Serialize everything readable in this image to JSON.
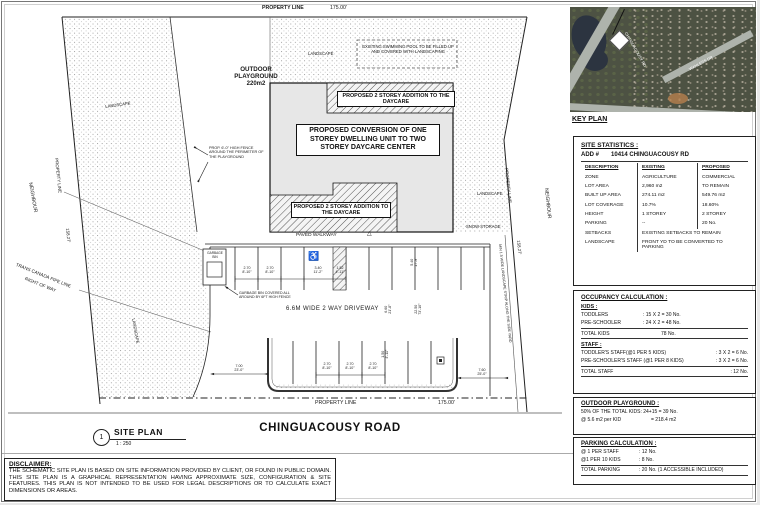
{
  "keyplan": {
    "label": "KEY PLAN",
    "road1": "CHINGUACOUSY RD",
    "road2": "WANLESS DR"
  },
  "stats": {
    "title": "SITE STATISTICS :",
    "addr_label": "ADD #",
    "addr": "10414 CHINGUACOUSY RD",
    "h_desc": "DESCRIPTION",
    "h_exist": "EXISTING",
    "h_prop": "PROPOSED",
    "rows": [
      {
        "d": "ZONE",
        "e": "AGRICULTURE",
        "p": "COMMERCIAL"
      },
      {
        "d": "LOT AREA",
        "e": "2,960 m2",
        "p": "TO REMAIN"
      },
      {
        "d": "BUILT UP AREA",
        "e": "274.11 m2",
        "p": "549.76 m2"
      },
      {
        "d": "LOT COVERAGE",
        "e": "10.7%",
        "p": "18.60%"
      },
      {
        "d": "HEIGHT",
        "e": "1 STOREY",
        "p": "2 STOREY"
      },
      {
        "d": "PARKING",
        "e": "--",
        "p": "20 No."
      }
    ],
    "span_rows": [
      {
        "d": "SETBACKS",
        "v": "EXISTING SETBACKS TO REMAIN"
      },
      {
        "d": "LANDSCAPE",
        "v": "FRONT YD TO BE CONVERTED TO PARKING"
      }
    ]
  },
  "occupancy": {
    "title": "OCCUPANCY CALCULATION :",
    "kids_title": "KIDS :",
    "kids": [
      {
        "l": "TODDLERS",
        "v": ": 15 X 2 = 30 No."
      },
      {
        "l": "PRE-SCHOOLER",
        "v": ": 24 X 2 = 48 No."
      }
    ],
    "kids_total_l": "TOTAL KIDS",
    "kids_total_v": "78 No.",
    "staff_title": "STAFF :",
    "staff": [
      {
        "l": "TODDLER'S STAFF(@1 PER 5 KIDS)",
        "v": ": 3 X 2 = 6 No."
      },
      {
        "l": "PRE-SCHOOLER'S STAFF (@1 PER 8 KIDS)",
        "v": ": 3 X 2 = 6 No."
      }
    ],
    "staff_total_l": "TOTAL STAFF",
    "staff_total_v": ": 12 No."
  },
  "playground_calc": {
    "title": "OUTDOOR PLAYGROUND :",
    "line1": "50% OF THE TOTAL KIDS: 24+15 = 39 No.",
    "line2l": "@ 5.6 m2 per KID",
    "line2v": "= 218.4 m2"
  },
  "parking_calc": {
    "title": "PARKING CALCULATION :",
    "rows": [
      {
        "l": "@ 1 PER STAFF",
        "v": ": 12 No."
      },
      {
        "l": "@1 PER 10 KIDS",
        "v": ": 8 No."
      }
    ],
    "total_l": "TOTAL PARKING",
    "total_v": ": 20 No. (1 ACCESSIBLE INCLUDED)"
  },
  "disclaimer": {
    "title": "DISCLAIMER:",
    "body": "THE SCHEMATIC SITE PLAN IS BASED ON SITE INFORMATION PROVIDED BY CLIENT, OR FOUND IN PUBLIC DOMAIN. THIS SITE PLAN IS A GRAPHICAL REPRESENTATION HAVING APPROXIMATE SIZE, CONFIGURATION & SITE FEATURES. THIS PLAN IS NOT INTENDED TO BE USED FOR LEGAL DESCRIPTIONS OR TO CALCULATE EXACT DIMENSIONS OR AREAS."
  },
  "titlebar": {
    "road": "CHINGUACOUSY ROAD",
    "sheet": "SITE PLAN",
    "scale": "1 : 250",
    "num": "1"
  },
  "plan": {
    "property_line": "PROPERTY LINE",
    "dim_w": "175.00'",
    "dim_h": "158.27'",
    "neighbour": "NEIGHBOUR",
    "pipeline1": "TRANS CANADA PIPE LINE",
    "pipeline2": "RIGHT OF WAY",
    "strip": "MIN 1.5 WIDE LANDSCAPE STRIP ALONG THE SIDE YARD",
    "playground_name": "OUTDOOR PLAYGROUND",
    "playground_area": "220m2",
    "landscape": "LANDSCAPE",
    "snow": "SNOW STORAGE",
    "pool": "EXISTING SWIMMING POOL TO BE FILLED UP AND COVERED WITH LANDSCAPING",
    "addition": "PROPOSED 2 STOREY ADDITION TO THE DAYCARE",
    "building": "PROPOSED CONVERSION OF ONE STOREY DWELLING UNIT TO TWO STOREY DAYCARE CENTER",
    "walkway": "PAVED WALKWAY",
    "driveway": "6.6M WIDE 2 WAY DRIVEWAY",
    "garbage": "GARBAGE BIN",
    "garbage_note": "GARBAGE BIN COVERED ALL AROUND BY 6FT HIGH FENCE",
    "fence_note": "PROP. 6'-0\" HIGH FENCE AROUND THE PERIMETER OF THE PLAYGROUND",
    "wheelchair_icon": "♿",
    "tri": "△",
    "dims": {
      "m270": "2.70",
      "f270": "8'-10\"",
      "m340": "3.40",
      "f340": "11'-2\"",
      "m152": "1.52",
      "f152": "4'-11\"",
      "m700": "7.00",
      "f700": "23'-0\"",
      "m540": "5.40",
      "f540": "17'-9\"",
      "m660": "6.60",
      "f660": "21'-8\"",
      "m2250": "22.50",
      "f2250": "73'-10\"",
      "m760": "7.60",
      "f760": "25'-0\"",
      "m150": "1.50",
      "f150": "4'-11\""
    }
  }
}
